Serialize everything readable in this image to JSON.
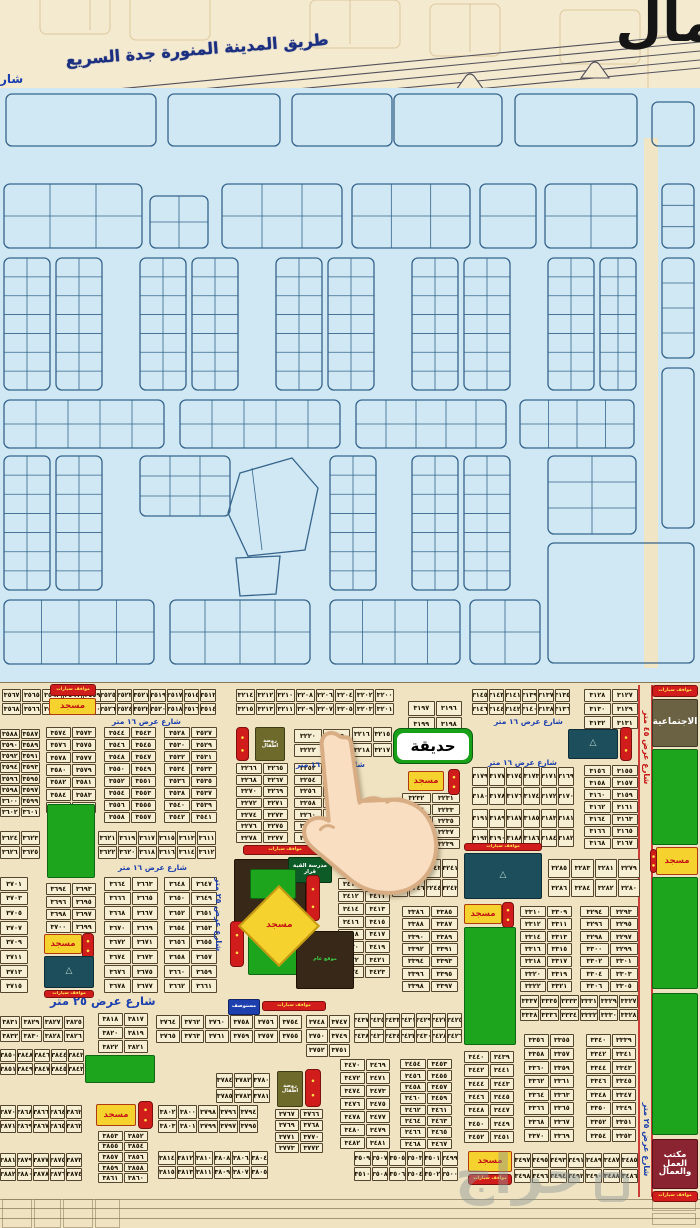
{
  "top": {
    "north_label": "مال",
    "highway_label": "طريق المدينة المنورة جدة السريع",
    "street_fragment": "شار"
  },
  "labels": {
    "park_callout": "حديقة",
    "mosque": "مسجد",
    "parking": "موقف سيارات",
    "parkings": "مواقف سيارات",
    "clinic": "مستوصف",
    "kindergarten": "روضة اطفال",
    "green_school": "مدرسة القبة قرار",
    "site": "موقع عام",
    "social": "الاجتماعية",
    "labor1": "مكتب العمل",
    "labor2": "والعمال",
    "street16": "شارع عرض ١٦ متر",
    "street25": "شارع عرض ٢٥ متر",
    "street45": "شارع عرض ٤٥ متر",
    "watermark": "حراج"
  },
  "street_labels": [
    [
      "s16",
      112,
      716,
      0
    ],
    [
      "s16",
      296,
      759,
      0
    ],
    [
      "s16",
      494,
      716,
      0
    ],
    [
      "s16",
      488,
      757,
      0
    ],
    [
      "s16",
      118,
      862,
      0
    ],
    [
      "s25",
      50,
      993,
      0
    ],
    [
      "v25",
      212,
      856,
      115
    ],
    [
      "v25",
      640,
      1096,
      84
    ],
    [
      "v45",
      640,
      688,
      116
    ]
  ],
  "features": [
    [
      "rs",
      50,
      683,
      46,
      12
    ],
    [
      "mosque",
      49,
      697,
      47,
      17
    ],
    [
      "rs",
      652,
      684,
      46,
      12
    ],
    [
      "social",
      652,
      698,
      46,
      48
    ],
    [
      "kind",
      255,
      726,
      30,
      34
    ],
    [
      "rv",
      236,
      726,
      13,
      34
    ],
    [
      "mosque",
      408,
      770,
      36,
      20
    ],
    [
      "rv",
      448,
      768,
      12,
      26
    ],
    [
      "teal",
      568,
      728,
      50,
      30
    ],
    [
      "rv",
      620,
      726,
      12,
      34
    ],
    [
      "park",
      652,
      748,
      46,
      96
    ],
    [
      "rs",
      243,
      844,
      84,
      10
    ],
    [
      "brown",
      234,
      858,
      72,
      72
    ],
    [
      "dg",
      288,
      856,
      44,
      26
    ],
    [
      "park",
      250,
      868,
      46,
      30
    ],
    [
      "rv",
      306,
      874,
      14,
      46
    ],
    [
      "rs",
      464,
      842,
      78,
      8
    ],
    [
      "teal",
      464,
      852,
      78,
      46
    ],
    [
      "park",
      248,
      934,
      50,
      40
    ],
    [
      "brown",
      296,
      930,
      58,
      58
    ],
    [
      "rv",
      230,
      920,
      14,
      46
    ],
    [
      "clinic",
      228,
      998,
      32,
      16
    ],
    [
      "rs",
      262,
      1000,
      64,
      10
    ],
    [
      "mosque",
      44,
      933,
      38,
      20
    ],
    [
      "rv",
      82,
      932,
      12,
      26
    ],
    [
      "teal",
      44,
      955,
      50,
      32
    ],
    [
      "rs",
      44,
      989,
      50,
      8
    ],
    [
      "mosque",
      464,
      903,
      38,
      20
    ],
    [
      "rv",
      502,
      901,
      12,
      26
    ],
    [
      "park",
      464,
      926,
      52,
      118
    ],
    [
      "mosque",
      656,
      846,
      42,
      28
    ],
    [
      "rv",
      650,
      848,
      7,
      24
    ],
    [
      "park",
      652,
      876,
      46,
      112
    ],
    [
      "park",
      652,
      992,
      46,
      142
    ],
    [
      "park",
      85,
      1054,
      70,
      28
    ],
    [
      "park",
      47,
      803,
      48,
      74
    ],
    [
      "kind",
      277,
      1070,
      26,
      36
    ],
    [
      "rv",
      305,
      1068,
      16,
      38
    ],
    [
      "mosque",
      96,
      1103,
      40,
      22
    ],
    [
      "rv",
      138,
      1100,
      15,
      28
    ],
    [
      "labor",
      652,
      1138,
      46,
      50
    ],
    [
      "rs",
      652,
      1190,
      46,
      11
    ],
    [
      "mosque",
      468,
      1150,
      44,
      21
    ],
    [
      "rs",
      468,
      1173,
      44,
      11
    ],
    [
      "mosque_d",
      250,
      896,
      58,
      58
    ]
  ],
  "blocks": [
    [
      2,
      688,
      100,
      26,
      5,
      [
        3567,
        3565,
        3563,
        3561,
        3559,
        3568,
        3566,
        3564,
        3562,
        3560
      ]
    ],
    [
      100,
      688,
      116,
      26,
      7,
      [
        3525,
        3523,
        3521,
        3519,
        3517,
        3515,
        3513,
        3526,
        3524,
        3522,
        3520,
        3518,
        3516,
        3514
      ]
    ],
    [
      236,
      688,
      158,
      26,
      8,
      [
        3214,
        3212,
        3210,
        3208,
        3206,
        3204,
        3202,
        3200,
        3215,
        3213,
        3211,
        3209,
        3207,
        3205,
        3203,
        3201
      ]
    ],
    [
      408,
      700,
      54,
      30,
      2,
      [
        3197,
        3196,
        3199,
        3198
      ]
    ],
    [
      472,
      688,
      98,
      26,
      6,
      [
        3145,
        3143,
        3141,
        3139,
        3137,
        3135,
        3146,
        3144,
        3142,
        3140,
        3138,
        3136
      ]
    ],
    [
      584,
      688,
      54,
      40,
      2,
      [
        3128,
        3127,
        3130,
        3129,
        3132,
        3131
      ]
    ],
    [
      0,
      728,
      40,
      88,
      2,
      [
        3588,
        3587,
        3590,
        3589,
        3592,
        3591,
        3594,
        3593,
        3596,
        3595,
        3598,
        3597,
        3600,
        3599,
        3602,
        3601
      ]
    ],
    [
      46,
      726,
      50,
      86,
      2,
      [
        3574,
        3573,
        3576,
        3575,
        3578,
        3577,
        3580,
        3579,
        3582,
        3581,
        3584,
        3583,
        3586,
        3585
      ]
    ],
    [
      104,
      726,
      52,
      96,
      2,
      [
        3544,
        3543,
        3546,
        3545,
        3548,
        3547,
        3550,
        3549,
        3552,
        3551,
        3554,
        3553,
        3556,
        3555,
        3558,
        3557
      ]
    ],
    [
      164,
      726,
      53,
      96,
      2,
      [
        3528,
        3527,
        3530,
        3529,
        3532,
        3531,
        3534,
        3533,
        3536,
        3535,
        3538,
        3537,
        3540,
        3539,
        3542,
        3541
      ]
    ],
    [
      236,
      762,
      52,
      80,
      2,
      [
        3266,
        3265,
        3268,
        3267,
        3270,
        3269,
        3272,
        3271,
        3274,
        3273,
        3276,
        3275,
        3278,
        3277
      ]
    ],
    [
      294,
      762,
      56,
      80,
      2,
      [
        3252,
        3251,
        3254,
        3253,
        3256,
        3255,
        3258,
        3257,
        3260,
        3259,
        3262,
        3261,
        3264,
        3263
      ]
    ],
    [
      294,
      728,
      56,
      28,
      2,
      [
        3220,
        3219,
        3222,
        3221
      ]
    ],
    [
      352,
      726,
      40,
      30,
      2,
      [
        3216,
        3215,
        3218,
        3217
      ]
    ],
    [
      402,
      792,
      58,
      56,
      2,
      [
        3232,
        3231,
        3234,
        3233,
        3236,
        3235,
        3238,
        3237,
        3240,
        3239
      ]
    ],
    [
      472,
      766,
      102,
      38,
      6,
      [
        3179,
        3177,
        3175,
        3173,
        3171,
        3169,
        3180,
        3178,
        3176,
        3174,
        3172,
        3170
      ]
    ],
    [
      472,
      808,
      102,
      38,
      6,
      [
        3191,
        3189,
        3187,
        3185,
        3183,
        3181,
        3192,
        3190,
        3188,
        3186,
        3184,
        3182
      ]
    ],
    [
      584,
      764,
      54,
      84,
      2,
      [
        3156,
        3155,
        3158,
        3157,
        3160,
        3159,
        3162,
        3161,
        3164,
        3163,
        3166,
        3165,
        3168,
        3167
      ]
    ],
    [
      392,
      858,
      66,
      38,
      4,
      [
        3247,
        3245,
        3243,
        3241,
        3248,
        3246,
        3244,
        3242
      ]
    ],
    [
      548,
      858,
      92,
      38,
      4,
      [
        3285,
        3283,
        3281,
        3279,
        3286,
        3284,
        3282,
        3280
      ]
    ],
    [
      338,
      877,
      52,
      100,
      2,
      [
        3410,
        3409,
        3412,
        3411,
        3414,
        3413,
        3416,
        3415,
        3418,
        3417,
        3420,
        3419,
        3422,
        3421,
        3424,
        3423
      ]
    ],
    [
      580,
      905,
      58,
      86,
      2,
      [
        3294,
        3293,
        3296,
        3295,
        3298,
        3297,
        3300,
        3299,
        3302,
        3301,
        3304,
        3303,
        3306,
        3305
      ]
    ],
    [
      520,
      905,
      52,
      86,
      2,
      [
        3310,
        3309,
        3312,
        3311,
        3314,
        3313,
        3316,
        3315,
        3318,
        3317,
        3320,
        3319,
        3322,
        3321
      ]
    ],
    [
      402,
      905,
      56,
      86,
      2,
      [
        3386,
        3385,
        3388,
        3387,
        3390,
        3389,
        3392,
        3391,
        3394,
        3393,
        3396,
        3395,
        3398,
        3397
      ]
    ],
    [
      520,
      994,
      118,
      26,
      6,
      [
        3337,
        3335,
        3333,
        3331,
        3329,
        3327,
        3338,
        3336,
        3334,
        3332,
        3330,
        3328
      ]
    ],
    [
      98,
      830,
      118,
      28,
      6,
      [
        3621,
        3619,
        3617,
        3615,
        3613,
        3611,
        3622,
        3620,
        3618,
        3616,
        3614,
        3612
      ]
    ],
    [
      0,
      830,
      40,
      28,
      2,
      [
        3624,
        3623,
        3626,
        3625
      ]
    ],
    [
      104,
      876,
      54,
      116,
      2,
      [
        3664,
        3663,
        3666,
        3665,
        3668,
        3667,
        3670,
        3669,
        3672,
        3671,
        3674,
        3673,
        3676,
        3675,
        3678,
        3677
      ]
    ],
    [
      164,
      876,
      53,
      116,
      2,
      [
        3648,
        3647,
        3650,
        3649,
        3652,
        3651,
        3654,
        3653,
        3656,
        3655,
        3658,
        3657,
        3660,
        3659,
        3662,
        3661
      ]
    ],
    [
      0,
      876,
      28,
      116,
      1,
      [
        3701,
        3703,
        3705,
        3707,
        3709,
        3711,
        3713,
        3715
      ]
    ],
    [
      46,
      882,
      50,
      50,
      2,
      [
        3694,
        3693,
        3696,
        3695,
        3698,
        3697,
        3700,
        3699
      ]
    ],
    [
      0,
      1015,
      84,
      26,
      4,
      [
        3831,
        3829,
        3827,
        3825,
        3832,
        3830,
        3828,
        3826
      ]
    ],
    [
      98,
      1012,
      50,
      40,
      2,
      [
        3818,
        3817,
        3820,
        3819,
        3822,
        3821
      ]
    ],
    [
      156,
      1014,
      146,
      28,
      6,
      [
        3764,
        3762,
        3760,
        3758,
        3756,
        3754,
        3765,
        3763,
        3761,
        3759,
        3757,
        3755
      ]
    ],
    [
      306,
      1014,
      44,
      42,
      2,
      [
        3748,
        3747,
        3750,
        3749,
        3752,
        3751
      ]
    ],
    [
      354,
      1012,
      108,
      30,
      7,
      [
        3437,
        3435,
        3433,
        3431,
        3429,
        3427,
        3425,
        3438,
        3436,
        3434,
        3432,
        3430,
        3428,
        3426
      ]
    ],
    [
      0,
      1048,
      84,
      26,
      5,
      [
        3850,
        3848,
        3846,
        3844,
        3842,
        3851,
        3849,
        3847,
        3845,
        3843
      ]
    ],
    [
      0,
      1104,
      82,
      28,
      5,
      [
        3870,
        3868,
        3866,
        3864,
        3862,
        3871,
        3869,
        3867,
        3865,
        3863
      ]
    ],
    [
      0,
      1152,
      82,
      28,
      5,
      [
        3881,
        3879,
        3877,
        3875,
        3873,
        3882,
        3880,
        3878,
        3876,
        3874
      ]
    ],
    [
      98,
      1130,
      50,
      52,
      2,
      [
        3853,
        3852,
        3855,
        3854,
        3857,
        3856,
        3859,
        3858,
        3861,
        3860
      ]
    ],
    [
      158,
      1104,
      100,
      28,
      5,
      [
        3802,
        3800,
        3798,
        3796,
        3794,
        3803,
        3801,
        3799,
        3797,
        3795
      ]
    ],
    [
      158,
      1150,
      110,
      28,
      6,
      [
        3814,
        3812,
        3810,
        3808,
        3806,
        3804,
        3815,
        3813,
        3811,
        3809,
        3807,
        3805
      ]
    ],
    [
      216,
      1072,
      54,
      30,
      3,
      [
        3784,
        3782,
        3780,
        3785,
        3783,
        3781
      ]
    ],
    [
      275,
      1108,
      48,
      44,
      2,
      [
        3767,
        3766,
        3769,
        3768,
        3771,
        3770,
        3773,
        3772
      ]
    ],
    [
      340,
      1058,
      50,
      90,
      2,
      [
        3470,
        3469,
        3472,
        3471,
        3474,
        3473,
        3476,
        3475,
        3478,
        3477,
        3480,
        3479,
        3482,
        3481
      ]
    ],
    [
      400,
      1058,
      52,
      90,
      2,
      [
        3454,
        3453,
        3456,
        3455,
        3458,
        3457,
        3460,
        3459,
        3462,
        3461,
        3464,
        3463,
        3466,
        3465,
        3468,
        3467
      ]
    ],
    [
      464,
      1050,
      50,
      92,
      2,
      [
        3440,
        3439,
        3442,
        3441,
        3444,
        3443,
        3446,
        3445,
        3448,
        3447,
        3450,
        3449,
        3452,
        3451
      ]
    ],
    [
      524,
      1033,
      50,
      108,
      2,
      [
        3356,
        3355,
        3358,
        3357,
        3360,
        3359,
        3362,
        3361,
        3364,
        3363,
        3366,
        3365,
        3368,
        3367,
        3370,
        3369
      ]
    ],
    [
      586,
      1033,
      50,
      108,
      2,
      [
        3340,
        3339,
        3342,
        3341,
        3344,
        3343,
        3346,
        3345,
        3348,
        3347,
        3350,
        3349,
        3352,
        3351,
        3354,
        3353
      ]
    ],
    [
      354,
      1150,
      104,
      30,
      6,
      [
        3509,
        3507,
        3505,
        3503,
        3501,
        3499,
        3510,
        3508,
        3506,
        3504,
        3502,
        3500
      ]
    ],
    [
      514,
      1152,
      124,
      30,
      7,
      [
        3497,
        3495,
        3493,
        3491,
        3489,
        3487,
        3485,
        3498,
        3496,
        3494,
        3492,
        3490,
        3488,
        3486
      ]
    ]
  ]
}
